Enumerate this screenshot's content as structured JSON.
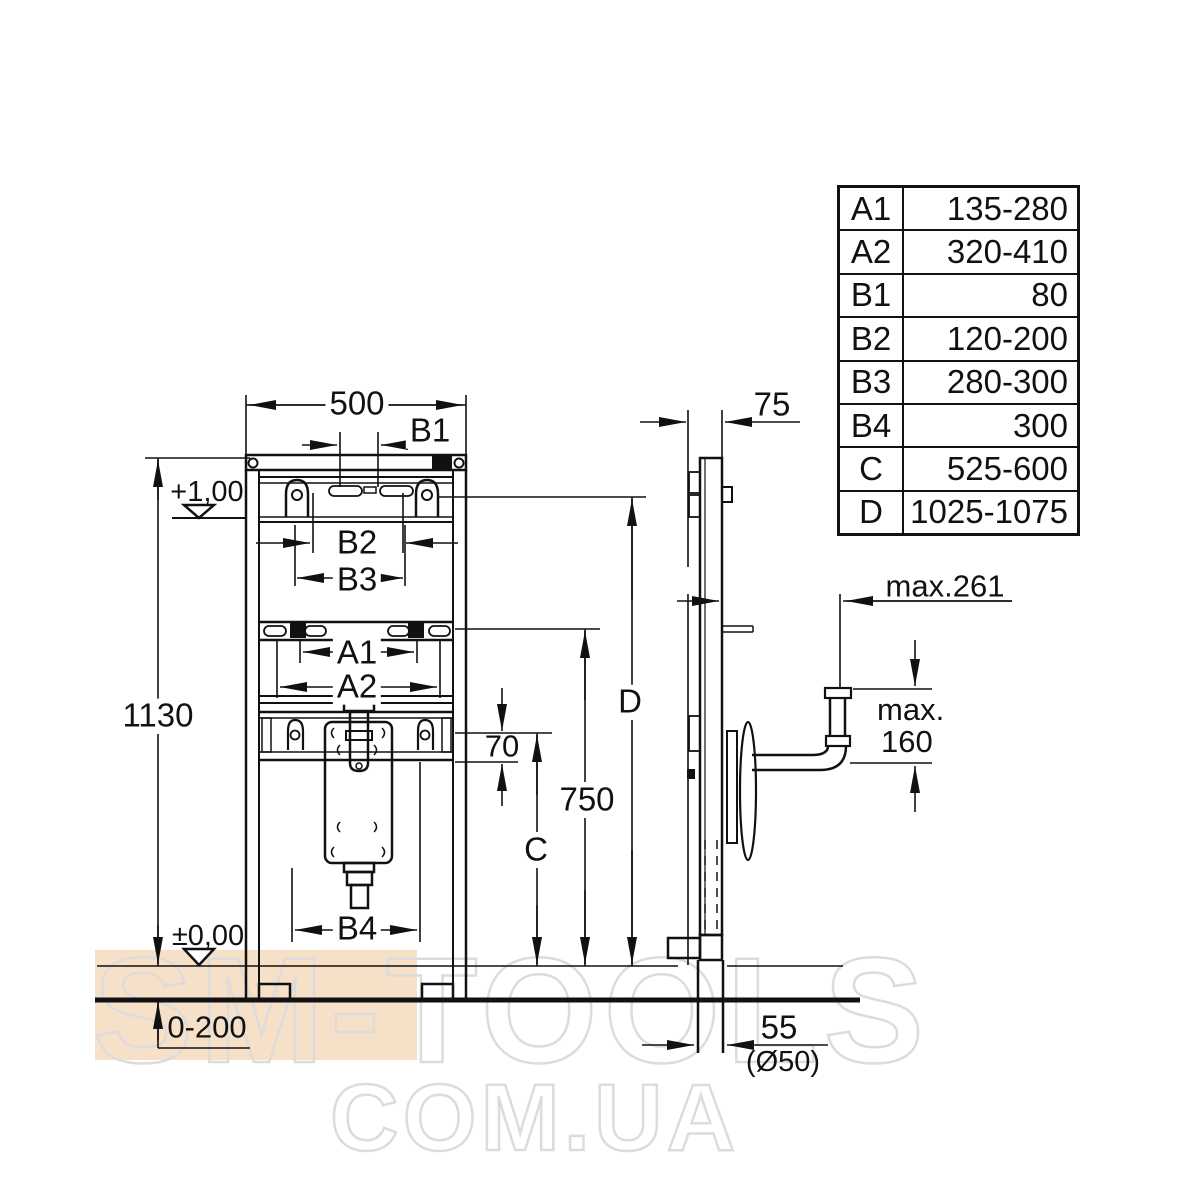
{
  "watermark": {
    "line1": "SM-TOOLS",
    "line2": "COM.UA",
    "accent_color": "#f6e0c8",
    "outline_color": "#dcdcdc"
  },
  "table": {
    "rows": [
      {
        "key": "A1",
        "value": "135-280"
      },
      {
        "key": "A2",
        "value": "320-410"
      },
      {
        "key": "B1",
        "value": "80"
      },
      {
        "key": "B2",
        "value": "120-200"
      },
      {
        "key": "B3",
        "value": "280-300"
      },
      {
        "key": "B4",
        "value": "300"
      },
      {
        "key": "C",
        "value": "525-600"
      },
      {
        "key": "D",
        "value": "1025-1075"
      }
    ]
  },
  "front_view": {
    "width": "500",
    "b1": "B1",
    "level_top": "+1,00",
    "b2": "B2",
    "b3": "B3",
    "a1": "A1",
    "a2": "A2",
    "height": "1130",
    "offset_70": "70",
    "height_750": "750",
    "c": "C",
    "d": "D",
    "b4": "B4",
    "level_floor": "±0,00",
    "foot_adjust": "0-200"
  },
  "side_view": {
    "depth": "75",
    "max_reach": "max.261",
    "max_height_line1": "max.",
    "max_height_line2": "160",
    "offset_55": "55",
    "pipe_diameter": "(Ø50)"
  }
}
